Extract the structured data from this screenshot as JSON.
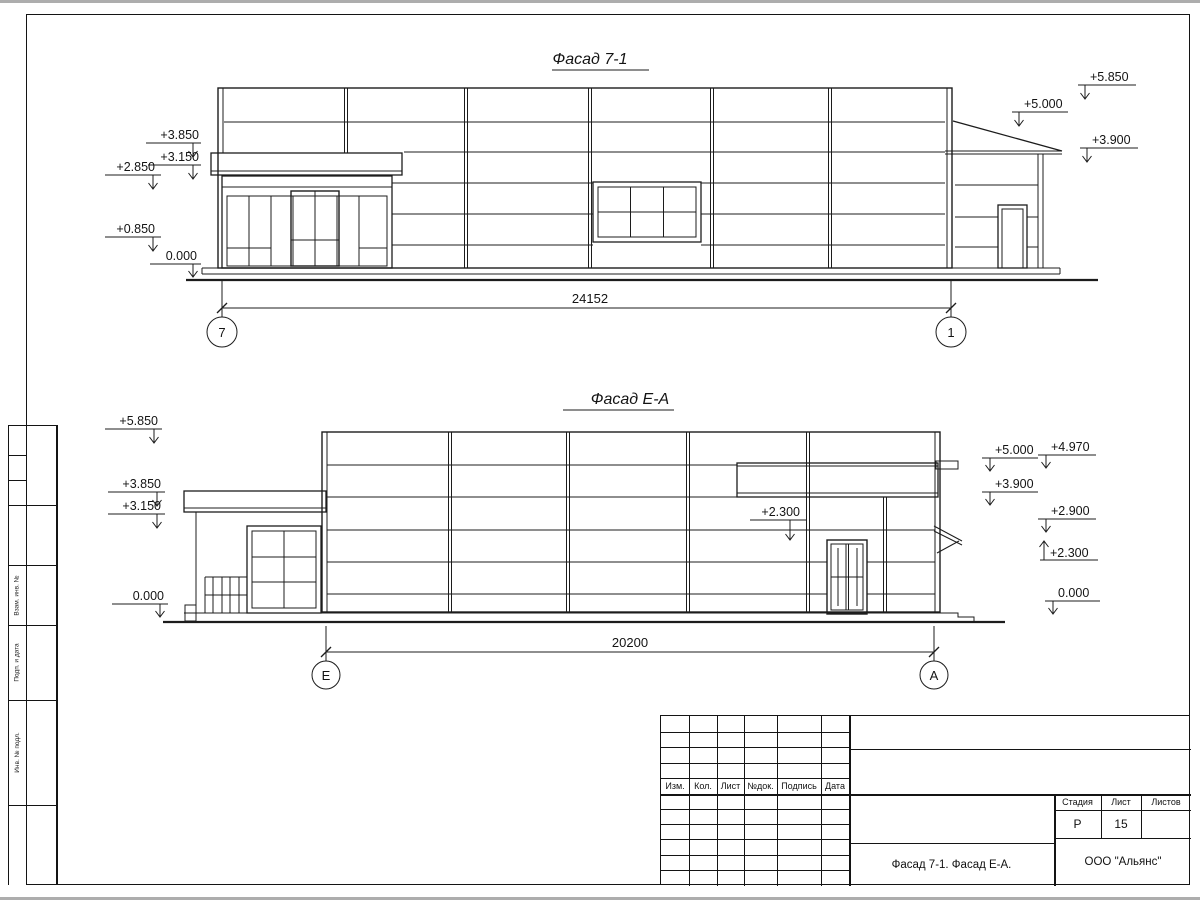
{
  "stamp_strip": {
    "labels": [
      "Взам. инв. №",
      "Подп. и дата",
      "Инв. № подл."
    ]
  },
  "facade_top": {
    "title": "Фасад 7-1",
    "marks_left": [
      "+3.850",
      "+3.150",
      "+2.850",
      "+0.850",
      "0.000"
    ],
    "marks_right": [
      "+5.850",
      "+5.000",
      "+3.900"
    ],
    "dimension": "24152",
    "axis_left": "7",
    "axis_right": "1"
  },
  "facade_bottom": {
    "title": "Фасад Е-А",
    "marks_left": [
      "+5.850",
      "+3.850",
      "+3.150",
      "0.000"
    ],
    "marks_right": [
      "+5.000",
      "+3.900",
      "+4.970",
      "+2.900",
      "+2.300",
      "0.000"
    ],
    "mark_middle": "+2.300",
    "dimension": "20200",
    "axis_left": "Е",
    "axis_right": "А"
  },
  "title_block": {
    "revision_headers": [
      "Изм.",
      "Кол.",
      "Лист",
      "№док.",
      "Подпись",
      "Дата"
    ],
    "stage_label": "Стадия",
    "sheet_label": "Лист",
    "sheets_label": "Листов",
    "stage_value": "Р",
    "sheet_value": "15",
    "sheets_value": "",
    "drawing_name": "Фасад 7-1. Фасад Е-А.",
    "company": "ООО \"Альянс\""
  }
}
